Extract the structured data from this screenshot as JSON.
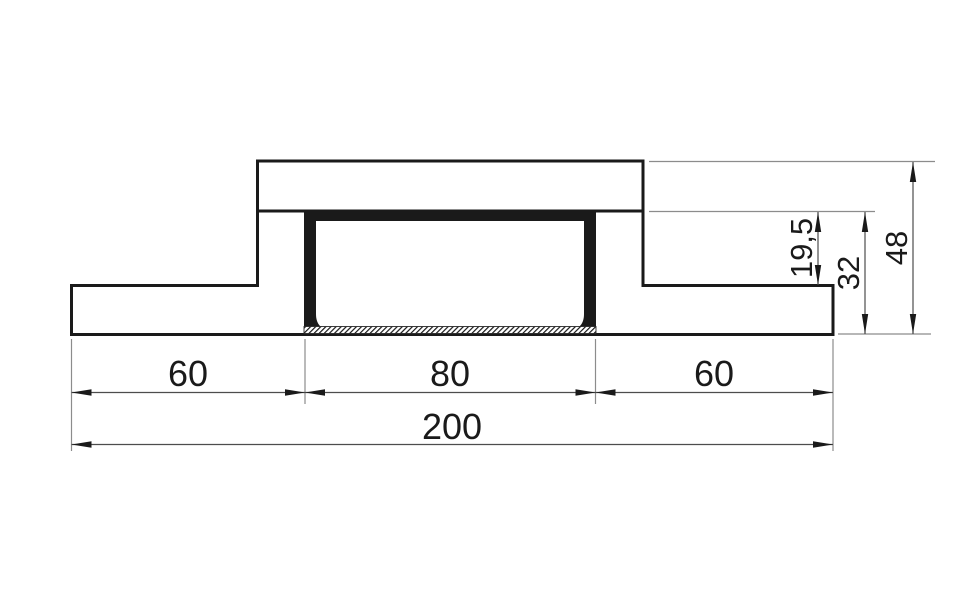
{
  "drawing": {
    "description": "Cross-section of a recessed channel profile with dimension annotations",
    "dims": {
      "left_wing": "60",
      "channel_width": "80",
      "right_wing": "60",
      "total_width": "200",
      "flange_offset": "19,5",
      "channel_depth": "32",
      "total_height": "48"
    },
    "colors": {
      "background": "#ffffff",
      "outline": "#1a1a1a",
      "fill_section": "#1a1a1a",
      "dimension_line": "#4d4d4d",
      "extension_line": "#8c8c8c",
      "text": "#1a1a1a"
    }
  }
}
